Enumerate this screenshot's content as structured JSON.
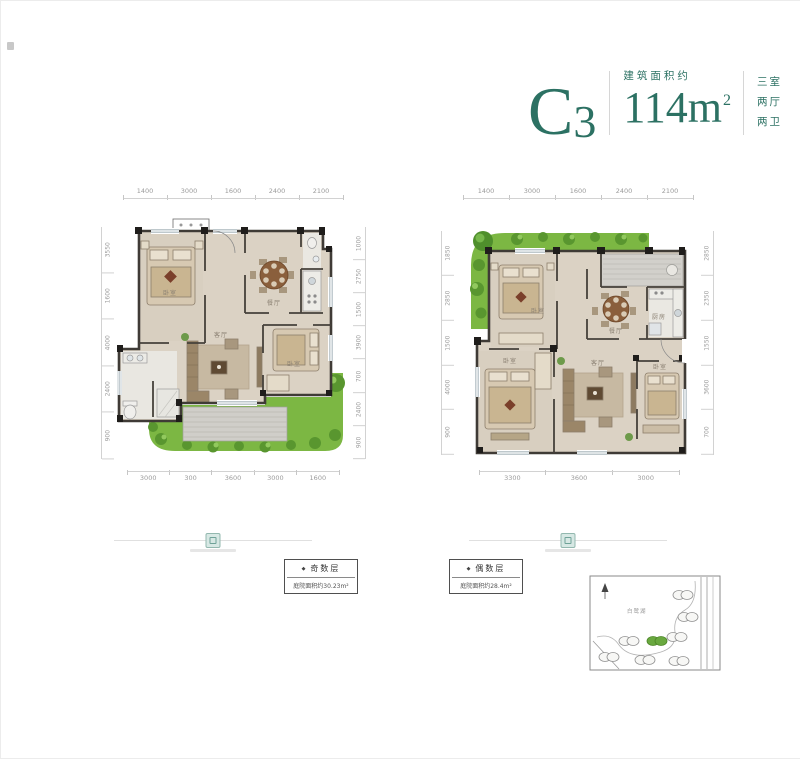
{
  "header": {
    "unit_code_letter": "C",
    "unit_code_number": "3",
    "area_label": "建筑面积约",
    "area_number": "114",
    "area_unit": "m",
    "area_sup": "2",
    "layout_lines": [
      "三室",
      "两厅",
      "两卫"
    ]
  },
  "plans": {
    "left": {
      "dims_top": [
        "1400",
        "3000",
        "1600",
        "2400",
        "2100"
      ],
      "dims_left": [
        "3550",
        "1600",
        "4000",
        "2400",
        "900"
      ],
      "dims_right": [
        "1000",
        "2750",
        "1500",
        "3900",
        "700",
        "2400",
        "900"
      ],
      "dims_bottom": [
        "3000",
        "300",
        "3600",
        "3000",
        "1600"
      ],
      "rooms": {
        "bedroom1": "卧室",
        "dining": "餐厅",
        "living": "客厅",
        "bedroom2": "卧室"
      }
    },
    "right": {
      "dims_top": [
        "1400",
        "3000",
        "1600",
        "2400",
        "2100"
      ],
      "dims_left": [
        "1850",
        "2850",
        "1500",
        "4000",
        "900"
      ],
      "dims_right": [
        "2850",
        "2350",
        "1550",
        "3600",
        "700"
      ],
      "dims_bottom": [
        "3300",
        "3600",
        "3000"
      ],
      "rooms": {
        "bedroom1": "卧室",
        "dining": "餐厅",
        "kitchen": "厨房",
        "living": "客厅",
        "bedroom2": "卧室",
        "bedroom3": "卧室"
      }
    }
  },
  "notes": {
    "odd": {
      "bullet": "◆",
      "title": "奇数层",
      "area": "庭院面积约30.23m²"
    },
    "even": {
      "bullet": "◆",
      "title": "偶数层",
      "area": "庭院面积约28.4m²"
    }
  },
  "sitemap": {
    "label": "白鹭湖"
  },
  "colors": {
    "accent": "#2c7163",
    "garden": "#7cb743",
    "wall": "#3f3b36",
    "floor": "#dbd2c4"
  }
}
